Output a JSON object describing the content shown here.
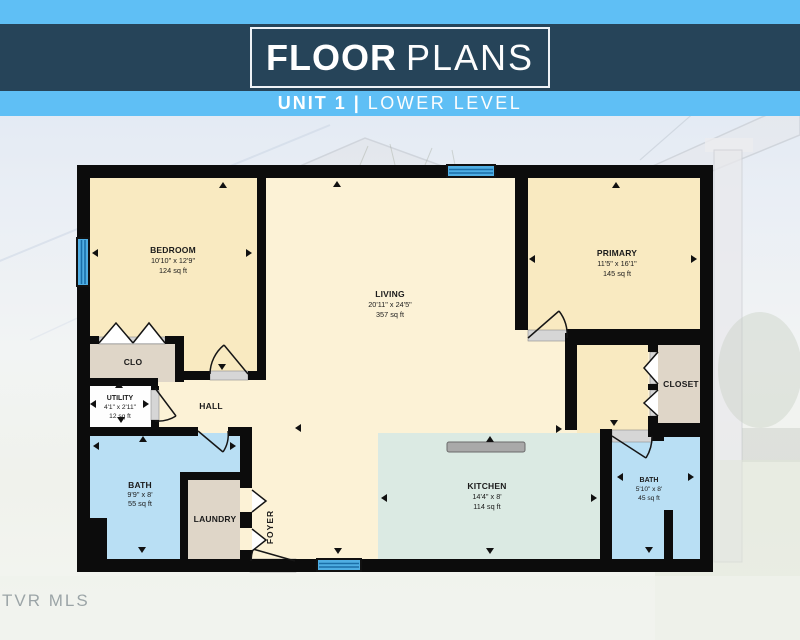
{
  "header": {
    "title_primary": "FLOOR",
    "title_secondary": "PLANS",
    "subtitle_primary": "UNIT 1 |",
    "subtitle_secondary": "LOWER LEVEL"
  },
  "watermark": "TVR MLS",
  "plan": {
    "rooms": [
      {
        "name": "BEDROOM",
        "dims": "10'10\" x 12'9\"",
        "area": "124 sq ft"
      },
      {
        "name": "LIVING",
        "dims": "20'11\" x 24'5\"",
        "area": "357 sq ft"
      },
      {
        "name": "PRIMARY",
        "dims": "11'5\" x 16'1\"",
        "area": "145 sq ft"
      },
      {
        "name": "CLO"
      },
      {
        "name": "UTILITY",
        "dims": "4'1\" x 2'11\"",
        "area": "12 sq ft"
      },
      {
        "name": "HALL"
      },
      {
        "name": "BATH",
        "dims": "9'9\" x 8'",
        "area": "55 sq ft"
      },
      {
        "name": "LAUNDRY"
      },
      {
        "name": "FOYER"
      },
      {
        "name": "KITCHEN",
        "dims": "14'4\" x 8'",
        "area": "114 sq ft"
      },
      {
        "name": "CLOSET"
      },
      {
        "name": "BATH",
        "dims": "5'10\" x 8'",
        "area": "45 sq ft"
      }
    ],
    "colors": {
      "wall": "#0c0c0c",
      "bedroom_cream": "#f9eac1",
      "living_cream": "#fcf2d6",
      "bath_blue": "#b9dff4",
      "kitchen_mint": "#dbeae3",
      "closet_tan": "#dfd6c8",
      "utility_white": "#fefefe",
      "window_blue": "#4faee3",
      "header_navy": "#264459",
      "header_blue": "#5fbff5"
    }
  }
}
